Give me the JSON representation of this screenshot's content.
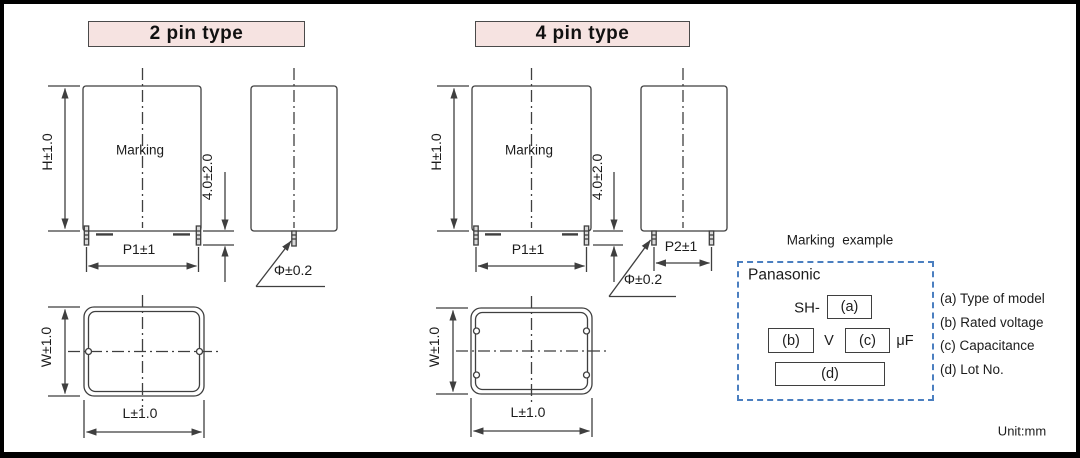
{
  "figure": {
    "unit_note": "Unit:mm",
    "colors": {
      "line": "#3f3f3f",
      "header_fill": "#f6e3e1",
      "header_border": "#4a4a4a",
      "marking_box_dash": "#4b7fc0"
    }
  },
  "two_pin": {
    "title": "2 pin type",
    "marking_label": "Marking",
    "dims": {
      "height": "H±1.0",
      "lead_length": "4.0±2.0",
      "pitch1": "P1±1",
      "lead_diameter": "Φ±0.2",
      "width": "W±1.0",
      "length": "L±1.0"
    }
  },
  "four_pin": {
    "title": "4 pin type",
    "marking_label": "Marking",
    "dims": {
      "height": "H±1.0",
      "lead_length": "4.0±2.0",
      "pitch1": "P1±1",
      "pitch2": "P2±1",
      "lead_diameter": "Φ±0.2",
      "width": "W±1.0",
      "length": "L±1.0"
    }
  },
  "marking_example": {
    "title": "Marking  example",
    "brand": "Panasonic",
    "model_prefix": "SH-",
    "field_a": "(a)",
    "field_b": "(b)",
    "field_c": "(c)",
    "field_d": "(d)",
    "voltage_unit": "V",
    "capacitance_unit": "μF",
    "legend": [
      "(a) Type of model",
      "(b) Rated voltage",
      "(c) Capacitance",
      "(d) Lot No."
    ]
  }
}
